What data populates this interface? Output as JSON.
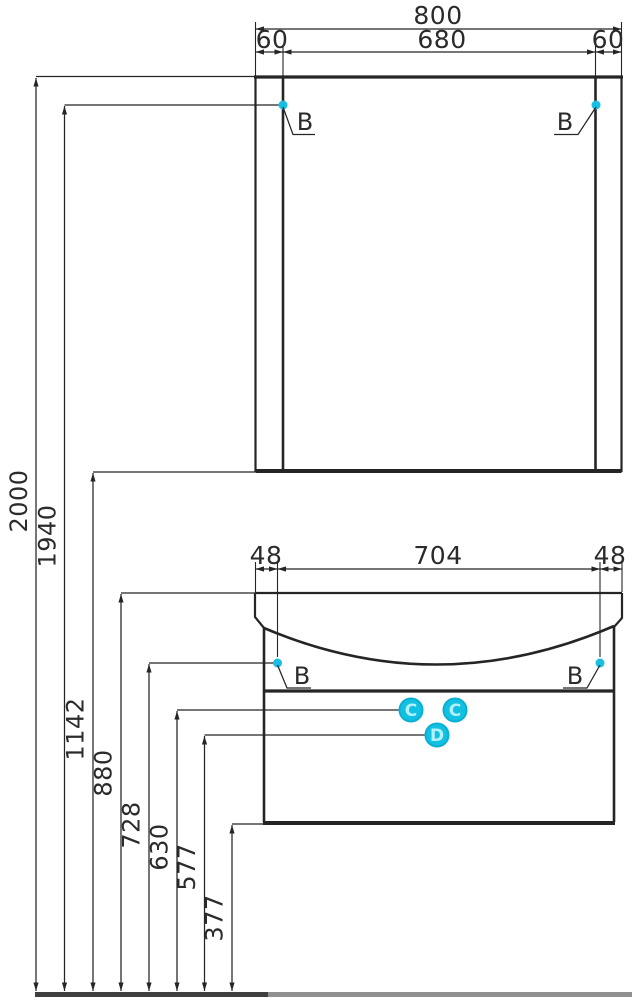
{
  "colors": {
    "line": "#252525",
    "accent_cyan": "#12c1e1",
    "badge_text": "#b4f1ff",
    "floor_dark": "#3f3f3f",
    "floor_light": "#909090"
  },
  "mirror": {
    "width_total": "800",
    "width_left": "60",
    "width_center": "680",
    "width_right": "60",
    "marker_left": "B",
    "marker_right": "B"
  },
  "vanity": {
    "width_left": "48",
    "width_center": "704",
    "width_right": "48",
    "marker_left": "B",
    "marker_right": "B",
    "callout_c1": "C",
    "callout_c2": "C",
    "callout_d": "D"
  },
  "heights": {
    "h2000": "2000",
    "h1940": "1940",
    "h1142": "1142",
    "h880": "880",
    "h728": "728",
    "h630": "630",
    "h577": "577",
    "h377": "377"
  }
}
